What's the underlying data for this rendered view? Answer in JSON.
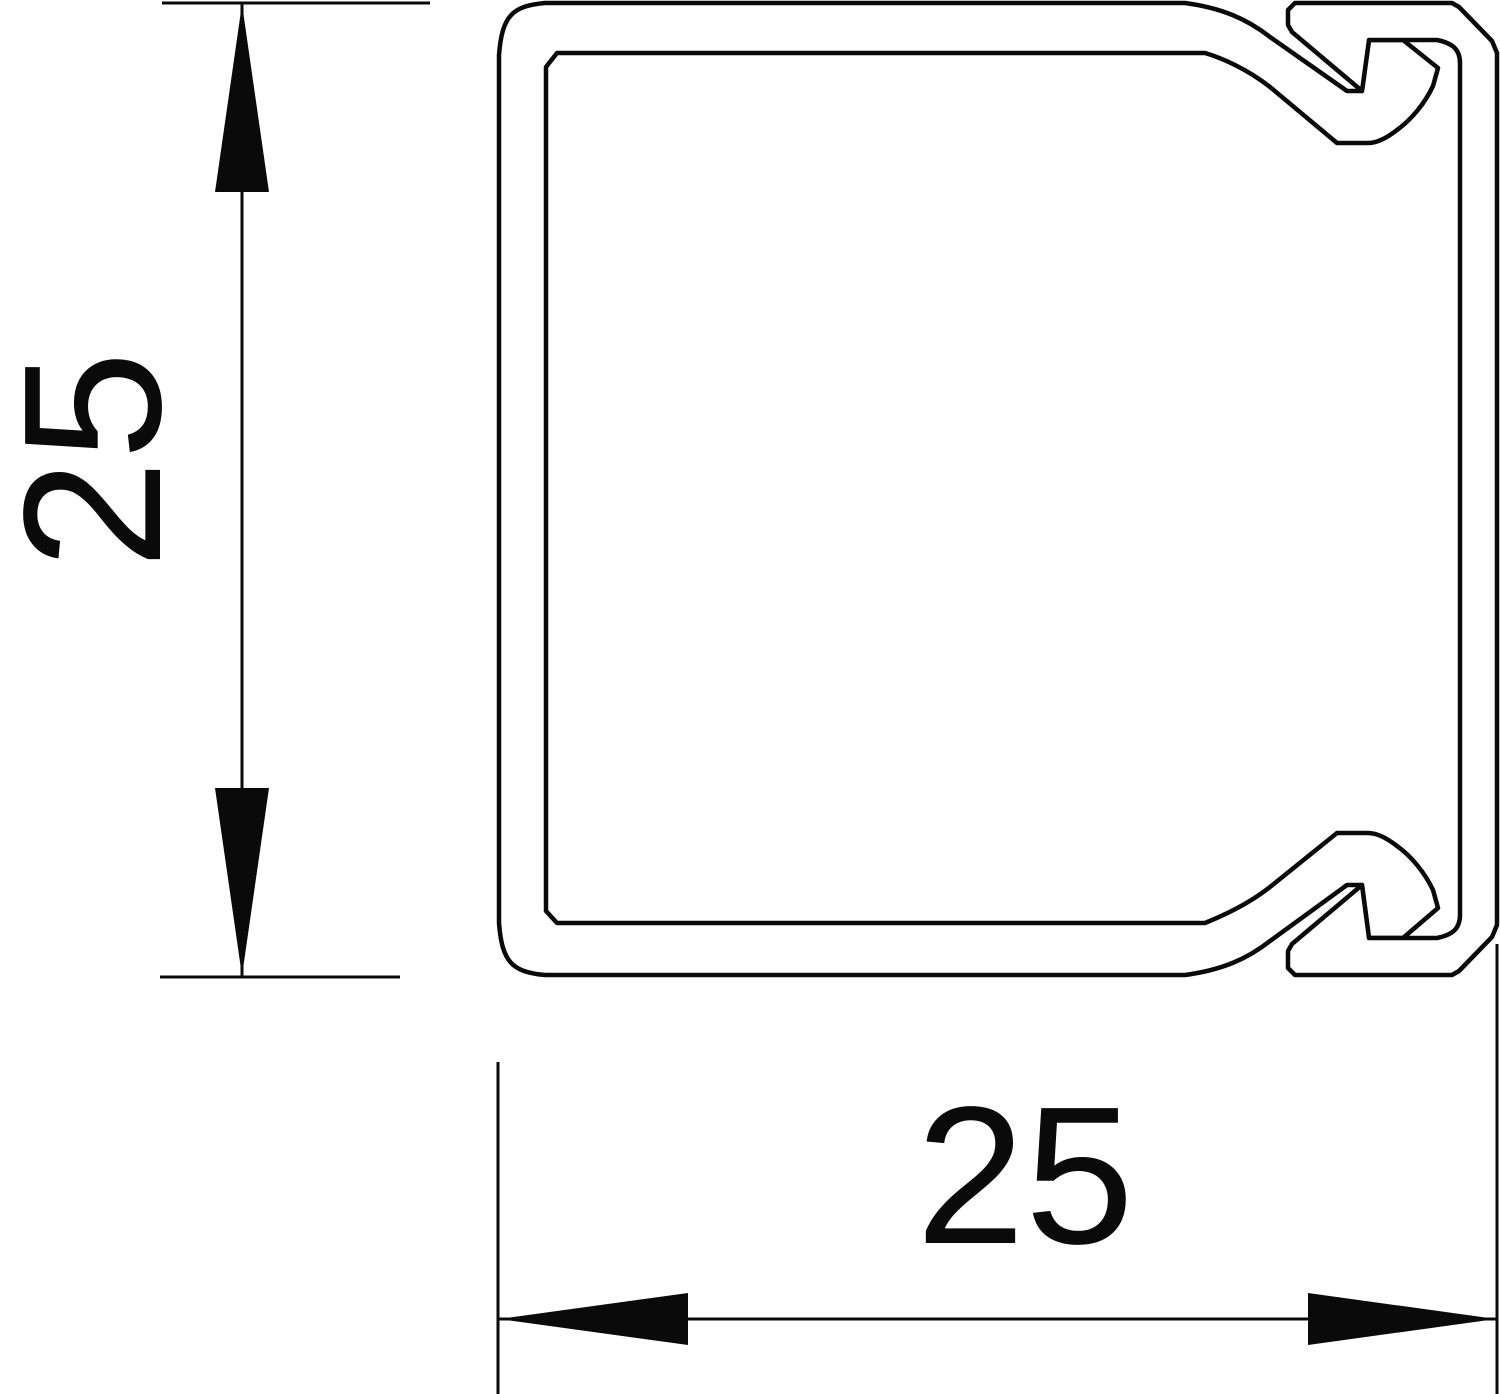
{
  "drawing": {
    "background_color": "#ffffff",
    "line_color": "#0a0a0a",
    "dimensions": {
      "height": {
        "label": "25",
        "orientation": "vertical"
      },
      "width": {
        "label": "25",
        "orientation": "horizontal"
      }
    }
  }
}
